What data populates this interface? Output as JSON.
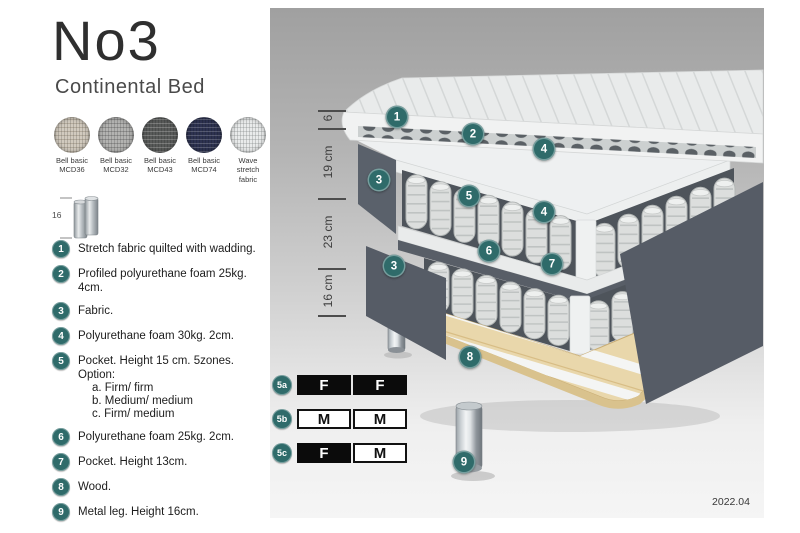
{
  "header": {
    "title": "No3",
    "subtitle": "Continental Bed"
  },
  "swatches": [
    {
      "line1": "Bell basic",
      "line2": "MCD36",
      "color": "#d1cabe",
      "weave": "rgba(90,80,60,0.25)"
    },
    {
      "line1": "Bell basic",
      "line2": "MCD32",
      "color": "#b3b3b1",
      "weave": "rgba(60,60,60,0.3)"
    },
    {
      "line1": "Bell basic",
      "line2": "MCD43",
      "color": "#585a59",
      "weave": "rgba(255,255,255,0.22)"
    },
    {
      "line1": "Bell basic",
      "line2": "MCD74",
      "color": "#2d3250",
      "weave": "rgba(255,255,255,0.2)"
    },
    {
      "line1": "Wave",
      "line2": "stretch fabric",
      "color": "#e9ebeb",
      "weave": "rgba(120,125,125,0.3)"
    }
  ],
  "leg_icon": {
    "height_label": "16"
  },
  "spec_list": [
    {
      "num": "1",
      "text": "Stretch fabric quilted with wadding."
    },
    {
      "num": "2",
      "text": "Profiled polyurethane foam 25kg. 4cm."
    },
    {
      "num": "3",
      "text": "Fabric."
    },
    {
      "num": "4",
      "text": "Polyurethane foam 30kg. 2cm."
    },
    {
      "num": "5",
      "text": "Pocket. Height 15 cm. 5zones. Option:",
      "sub": [
        "a. Firm/ firm",
        "b. Medium/ medium",
        "c. Firm/ medium"
      ]
    },
    {
      "num": "6",
      "text": "Polyurethane foam 25kg. 2cm."
    },
    {
      "num": "7",
      "text": "Pocket. Height 13cm."
    },
    {
      "num": "8",
      "text": "Wood."
    },
    {
      "num": "9",
      "text": "Metal leg. Height 16cm."
    }
  ],
  "diagram": {
    "measurements": [
      {
        "label": "6",
        "from_y": 102,
        "to_y": 120
      },
      {
        "label": "19 cm",
        "from_y": 120,
        "to_y": 190
      },
      {
        "label": "23 cm",
        "from_y": 190,
        "to_y": 260
      },
      {
        "label": "16 cm",
        "from_y": 260,
        "to_y": 307
      }
    ],
    "callouts": [
      {
        "n": "1",
        "x": 127,
        "y": 109
      },
      {
        "n": "2",
        "x": 203,
        "y": 126
      },
      {
        "n": "3",
        "x": 109,
        "y": 172
      },
      {
        "n": "4",
        "x": 274,
        "y": 141
      },
      {
        "n": "5",
        "x": 199,
        "y": 188
      },
      {
        "n": "4",
        "x": 274,
        "y": 204
      },
      {
        "n": "6",
        "x": 219,
        "y": 243
      },
      {
        "n": "7",
        "x": 282,
        "y": 256
      },
      {
        "n": "3",
        "x": 124,
        "y": 258
      },
      {
        "n": "8",
        "x": 200,
        "y": 349
      },
      {
        "n": "9",
        "x": 194,
        "y": 454
      }
    ],
    "firmness_options": [
      {
        "id": "5a",
        "cells": [
          {
            "text": "F",
            "variant": "dark"
          },
          {
            "text": "F",
            "variant": "dark"
          }
        ]
      },
      {
        "id": "5b",
        "cells": [
          {
            "text": "M",
            "variant": "light"
          },
          {
            "text": "M",
            "variant": "light"
          }
        ]
      },
      {
        "id": "5c",
        "cells": [
          {
            "text": "F",
            "variant": "dark"
          },
          {
            "text": "M",
            "variant": "light"
          }
        ]
      }
    ],
    "version": "2022.04"
  },
  "colors": {
    "accent_teal": "#2f6b6a",
    "fabric_dark": "#565c66",
    "spring": "#dcdedd",
    "wood": "#e9d7ab",
    "quilt": "#e9ebeb"
  }
}
